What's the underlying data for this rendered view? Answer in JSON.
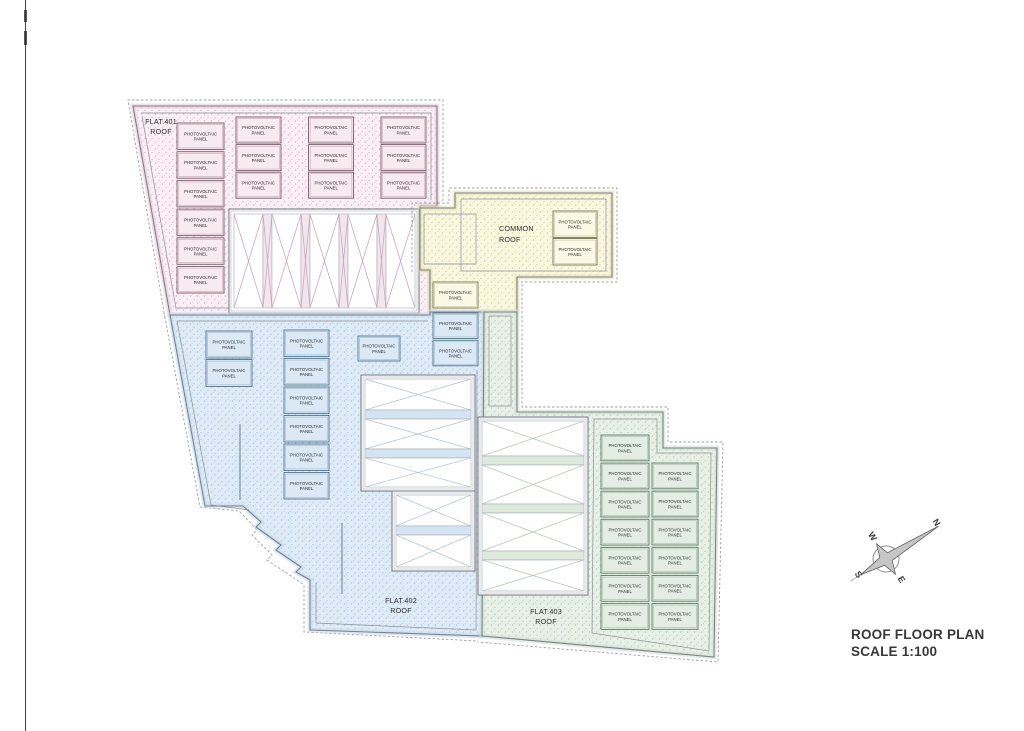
{
  "page": {
    "title_line1": "ROOF FLOOR PLAN",
    "title_line2": "SCALE 1:100"
  },
  "panel_label": {
    "line1": "PHOTOVOLTAIC",
    "line2": "PANEL"
  },
  "compass": {
    "n": "N",
    "e": "E",
    "s": "S",
    "w": "W"
  },
  "regions": [
    {
      "id": "flat401",
      "name": "FLAT.401 ROOF",
      "label_lines": [
        "FLAT.401",
        "ROOF"
      ],
      "colors": {
        "fill": "#f9eff4",
        "dots": "#dfb3cb",
        "band": "#e9cbd9",
        "stroke": "#8a7580",
        "panel_fill": "#f7ebf1",
        "panel_stroke": "#7d5a6a",
        "xline": "#c9abbc",
        "cell_band": "#f2e6ec"
      },
      "polygon": "133,106 437,106 437,206 420,206 420,270 430,270 430,315 170,315",
      "dash": [
        "165,318 128,100 443,100 443,203"
      ],
      "inner": [
        "141,113 431,113 431,200",
        "142,116 176,308 229,308"
      ],
      "lines": [],
      "skylights": [
        {
          "x": 229,
          "y": 209,
          "w": 190,
          "h": 104,
          "orient": "v",
          "margin": 5,
          "cells": [
            {
              "s": 29,
              "x": 1
            },
            {
              "s": 9,
              "x": 1,
              "n": 1
            },
            {
              "s": 29,
              "x": 1
            },
            {
              "s": 9,
              "x": 1,
              "n": 1
            },
            {
              "s": 29,
              "x": 1
            },
            {
              "s": 9,
              "x": 1,
              "n": 1
            },
            {
              "s": 29,
              "x": 1
            },
            {
              "s": 9,
              "x": 1,
              "n": 1
            },
            {
              "s": 29,
              "x": 1
            }
          ]
        }
      ],
      "panel_groups": [
        {
          "x": 177,
          "y": 123,
          "w": 47,
          "h": 26.5,
          "rows": 6,
          "cols": 1,
          "gx": 0,
          "gy": 2.2
        },
        {
          "x": 236,
          "y": 117,
          "w": 45,
          "h": 26,
          "rows": 3,
          "cols": 3,
          "gx": 27.5,
          "gy": 1.6
        }
      ]
    },
    {
      "id": "common",
      "name": "COMMON ROOF",
      "label_lines": [
        "COMMON",
        "ROOF"
      ],
      "colors": {
        "fill": "#f9f7e0",
        "dots": "#d9d49c",
        "band": "#e5e1b2",
        "stroke": "#8c8a6a",
        "panel_fill": "#fbf9e6",
        "panel_stroke": "#77764f",
        "xline": "#c9c6a0",
        "cell_band": "#f2efd2"
      },
      "polygon": "455,193 612,193 612,277 517,277 517,312 430,312 430,270 420,270 420,208 455,208",
      "dash": [
        "412,272 412,203 449,203 449,188 617,188 617,282 521,282"
      ],
      "inner": [
        "461,199 606,199 606,271 461,271 461,199",
        "424,214 476,214 476,264 424,264 424,214"
      ],
      "lines": [],
      "skylights": [],
      "panel_groups": [
        {
          "x": 553,
          "y": 211,
          "w": 44,
          "h": 26.5,
          "rows": 2,
          "cols": 1,
          "gx": 0,
          "gy": 1
        },
        {
          "x": 433,
          "y": 282,
          "w": 45,
          "h": 26,
          "rows": 1,
          "cols": 1,
          "gx": 0,
          "gy": 0
        }
      ]
    },
    {
      "id": "flat402",
      "name": "FLAT.402 ROOF",
      "label_lines": [
        "FLAT.402",
        "ROOF"
      ],
      "colors": {
        "fill": "#deebf7",
        "dots": "#a9c7e1",
        "band": "#c6dbee",
        "stroke": "#70808e",
        "panel_fill": "#dbe9f6",
        "panel_stroke": "#54748e",
        "xline": "#b6c7d6",
        "cell_band": "#d5e4f2"
      },
      "polygon": "170,315 430,315 430,312 484,312 482,636 310,630 310,580 296,572 301,567 276,550 281,545 256,527 261,522 243,506 205,506",
      "dash": [
        "164,312 200,507 239,511 257,530 252,535 272,555 267,560 291,576 304,585 304,632 478,641"
      ],
      "inner": [
        "177,321 428,321",
        "177,321 211,505 249,510",
        "477,370 476,630 316,623 316,583"
      ],
      "lines": [
        "240,424 240,500",
        "342,523 342,594"
      ],
      "skylights": [
        {
          "x": 361,
          "y": 375,
          "w": 114,
          "h": 116,
          "orient": "h",
          "margin": 4,
          "cells": [
            {
              "s": 31,
              "x": 1
            },
            {
              "s": 9,
              "n": 1
            },
            {
              "s": 30,
              "x": 1
            },
            {
              "s": 9,
              "n": 1
            },
            {
              "s": 29,
              "x": 1
            }
          ]
        },
        {
          "x": 392,
          "y": 491,
          "w": 83,
          "h": 80,
          "orient": "h",
          "margin": 4,
          "cells": [
            {
              "s": 31,
              "x": 1
            },
            {
              "s": 9,
              "n": 1
            },
            {
              "s": 32,
              "x": 1
            }
          ]
        }
      ],
      "panel_groups": [
        {
          "x": 206,
          "y": 331,
          "w": 46,
          "h": 27,
          "rows": 2,
          "cols": 1,
          "gx": 0,
          "gy": 1.5
        },
        {
          "x": 284,
          "y": 330,
          "w": 45,
          "h": 26.5,
          "rows": 6,
          "cols": 1,
          "gx": 0,
          "gy": 2
        },
        {
          "x": 358,
          "y": 336,
          "w": 42,
          "h": 25,
          "rows": 1,
          "cols": 1,
          "gx": 0,
          "gy": 0
        },
        {
          "x": 433,
          "y": 313,
          "w": 45,
          "h": 25.5,
          "rows": 2,
          "cols": 1,
          "gx": 0,
          "gy": 1.8
        }
      ]
    },
    {
      "id": "flat403",
      "name": "FLAT.403 ROOF",
      "label_lines": [
        "FLAT.403",
        "ROOF"
      ],
      "colors": {
        "fill": "#e7efe6",
        "dots": "#b4cdb7",
        "band": "#d2e1d3",
        "stroke": "#75857a",
        "panel_fill": "#e4ede3",
        "panel_stroke": "#5e7a64",
        "xline": "#b7c9ba",
        "cell_band": "#dde9db"
      },
      "polygon": "484,312 517,312 517,412 663,412 663,448 717,448 714,657 482,636",
      "dash": [
        "522,284 522,407 668,407 668,442 723,442 718,662 478,642"
      ],
      "inner": [
        "489,316 511,316 511,406 489,406 489,316",
        "594,419 657,419 657,453 711,453 709,651 592,633 594,419"
      ],
      "lines": [],
      "skylights": [
        {
          "x": 478,
          "y": 417,
          "w": 110,
          "h": 178,
          "orient": "h",
          "margin": 4,
          "cells": [
            {
              "s": 35,
              "x": 1
            },
            {
              "s": 9,
              "n": 1
            },
            {
              "s": 39,
              "x": 1
            },
            {
              "s": 9,
              "n": 1
            },
            {
              "s": 38,
              "x": 1
            },
            {
              "s": 9,
              "n": 1
            },
            {
              "s": 31,
              "x": 1
            }
          ]
        }
      ],
      "panel_groups": [
        {
          "x": 601,
          "y": 435,
          "w": 48,
          "h": 25.8,
          "rows": 7,
          "cols": 1,
          "gx": 0,
          "gy": 2.3
        },
        {
          "x": 652,
          "y": 463,
          "w": 46,
          "h": 25.8,
          "rows": 6,
          "cols": 1,
          "gx": 0,
          "gy": 2.3
        }
      ]
    }
  ]
}
